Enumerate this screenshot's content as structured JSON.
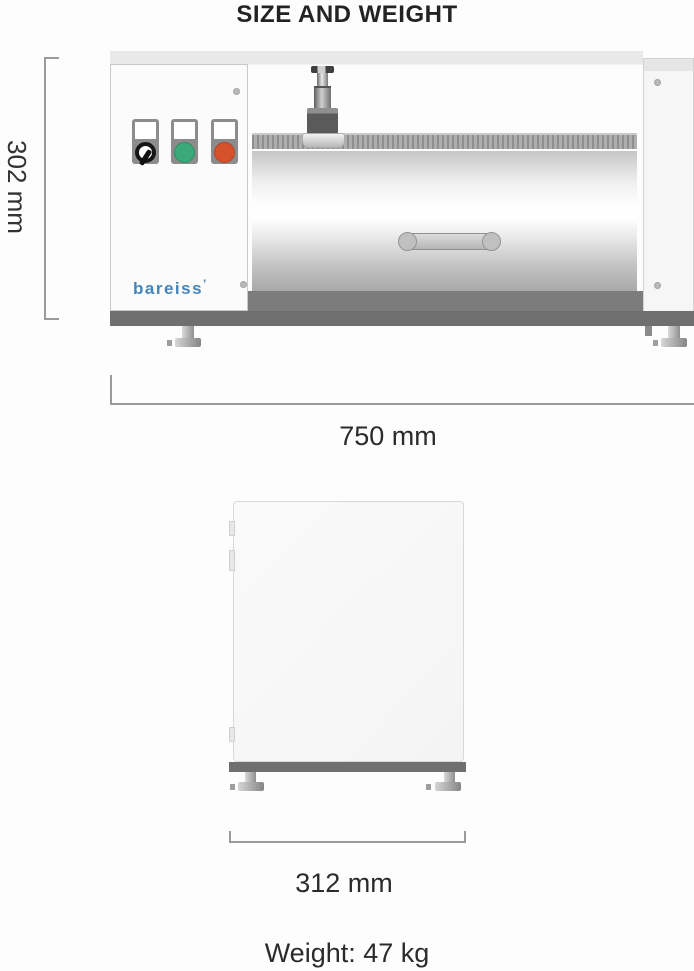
{
  "title": "SIZE AND WEIGHT",
  "front_view": {
    "height_label": "302 mm",
    "width_label": "750 mm",
    "brand": "bareiss",
    "brand_mark": "’"
  },
  "side_view": {
    "depth_label": "312 mm"
  },
  "weight_label": "Weight: 47 kg",
  "colors": {
    "brand_blue": "#4486bb",
    "button_green": "#3ba97a",
    "button_red": "#d4512b",
    "base_gray": "#6f6f6f",
    "dimension_line_gray": "#9a9a9a"
  }
}
